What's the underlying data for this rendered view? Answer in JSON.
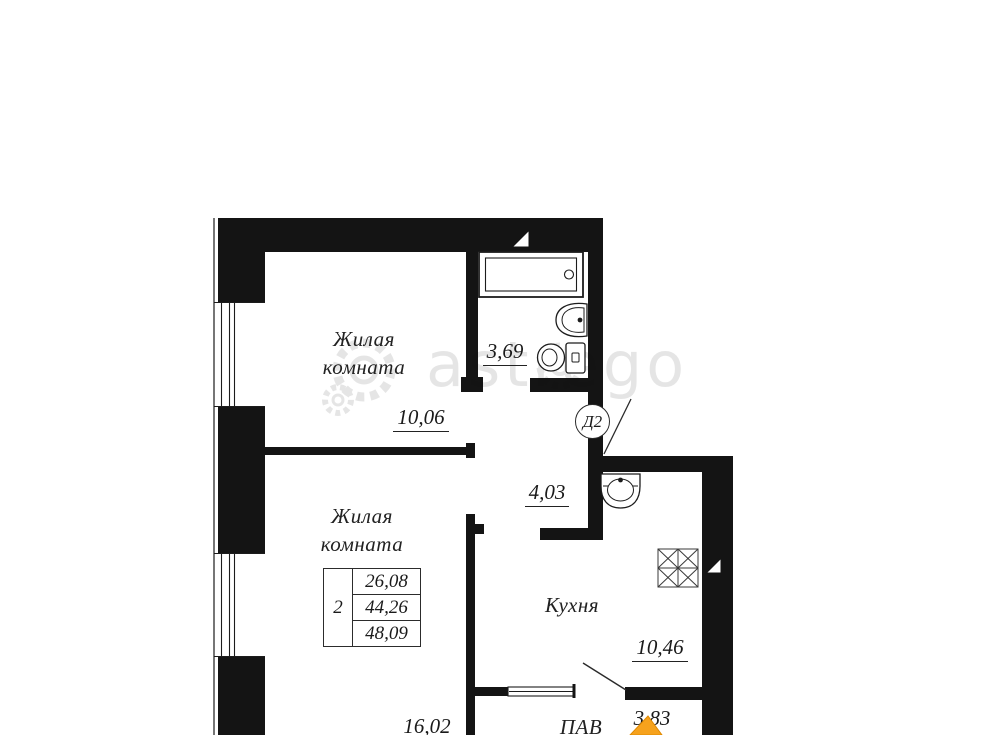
{
  "watermark": {
    "brand": "astrego"
  },
  "plan": {
    "door_label": "Д2",
    "living_room_1": {
      "label": "Жилая комната",
      "area": "10,06"
    },
    "living_room_2": {
      "label": "Жилая комната",
      "area": "16,02"
    },
    "bathroom": {
      "area": "3,69"
    },
    "hall_upper": {
      "area": "4,03"
    },
    "kitchen": {
      "label": "Кухня",
      "area": "10,46"
    },
    "hall_lower": {
      "label": "ПАВ",
      "area": "3,83"
    },
    "summary": {
      "rooms": "2",
      "living_area": "26,08",
      "area": "44,26",
      "total_area": "48,09"
    }
  },
  "colors": {
    "wall": "#141414",
    "logo_orange": "#f6a21d",
    "watermark_gray": "#111111"
  }
}
